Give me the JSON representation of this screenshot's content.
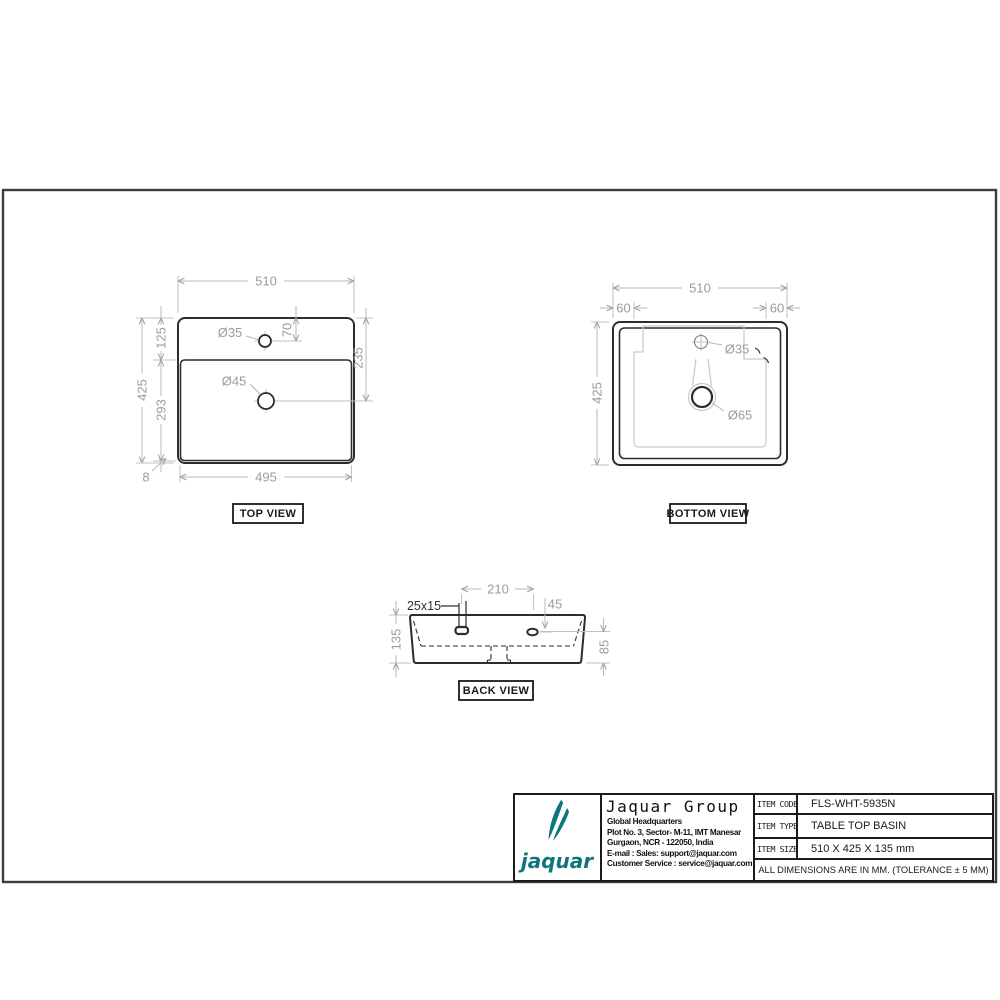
{
  "colors": {
    "outline": "#2d2d2d",
    "dim_line": "#b8b8b8",
    "dim_text": "#9b9b9b",
    "contour": "#c9c9c9",
    "frame": "#3d3d3d",
    "teal": "#0e757d"
  },
  "views": {
    "top": {
      "label": "TOP VIEW",
      "dim_width": "510",
      "dim_height": "425",
      "dim_rim_depth": "125",
      "dim_bowl_height": "293",
      "dim_bottom_width": "495",
      "dim_rim_gap": "8",
      "dim_faucet_offset": "70",
      "dim_drain_offset": "235",
      "faucet_hole": "Ø35",
      "drain_hole": "Ø45"
    },
    "bottom": {
      "label": "BOTTOM VIEW",
      "dim_width": "510",
      "dim_height": "425",
      "dim_inset_left": "60",
      "dim_inset_right": "60",
      "faucet_hole": "Ø35",
      "drain_hole": "Ø65"
    },
    "back": {
      "label": "BACK VIEW",
      "dim_hole_spacing": "210",
      "slot_size": "25x15",
      "dim_hole_offset": "45",
      "dim_height": "135",
      "dim_hole_height": "85"
    }
  },
  "title_block": {
    "logo_text": "jaquar",
    "company": "Jaquar Group",
    "address_lines": [
      "Global Headquarters",
      "Plot No. 3, Sector- M-11, IMT Manesar",
      "Gurgaon, NCR - 122050, India",
      "E-mail : Sales: support@jaquar.com",
      "Customer Service : service@jaquar.com"
    ],
    "rows": [
      {
        "label": "ITEM CODE",
        "value": "FLS-WHT-5935N"
      },
      {
        "label": "ITEM TYPE",
        "value": "TABLE TOP BASIN"
      },
      {
        "label": "ITEM SIZE",
        "value": "510 X 425 X 135 mm"
      }
    ],
    "note": "ALL DIMENSIONS ARE IN MM. (TOLERANCE ± 5 MM)"
  }
}
